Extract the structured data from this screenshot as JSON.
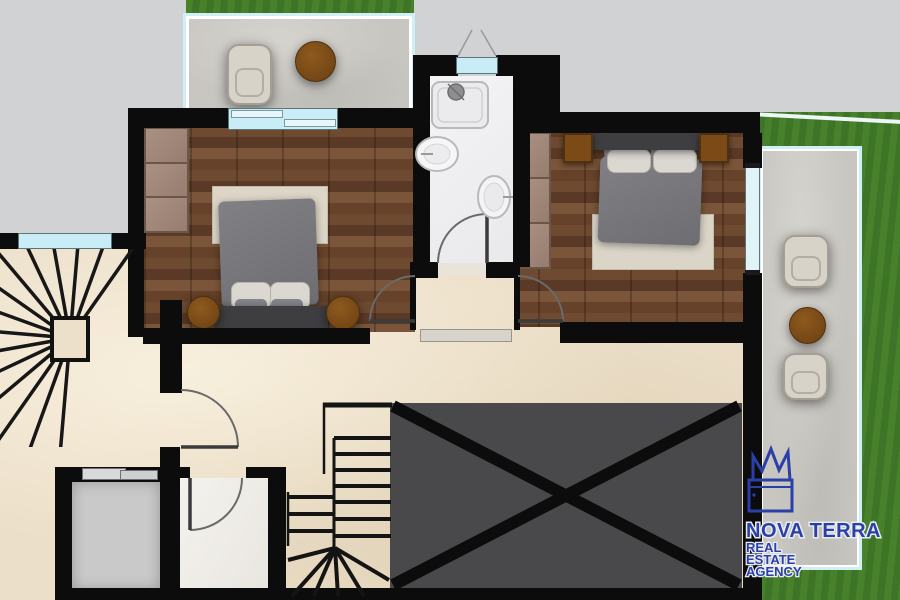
{
  "brand": {
    "name": "NOVA TERRA",
    "tagline_lines": [
      "REAL",
      "ESTATE",
      "AGENCY"
    ],
    "logo_color": "#2a3fa8",
    "logo_icon": "crown-castle-sketch"
  },
  "palette": {
    "outside": "#d1d2d3",
    "grass": "#447d2a",
    "wall": "#0c0c0d",
    "marble_floor": "#ecdfc9",
    "wood_floor": "#6e4a31",
    "stone_paving": "#c8c6c1",
    "glass": "#c8edf6",
    "void_fill": "#49494b",
    "wood_furniture": "#7c4a16",
    "bedding_gray": "#76767b",
    "wardrobe_panel": "#a18779"
  },
  "plan": {
    "type": "floor-plan-render",
    "rooms": [
      {
        "id": "bedroom-left",
        "floor": "wood",
        "furniture": [
          "double-bed",
          "wardrobe",
          "round-nightstand",
          "round-nightstand",
          "rug"
        ]
      },
      {
        "id": "bedroom-right",
        "floor": "wood",
        "furniture": [
          "double-bed",
          "wardrobe",
          "square-nightstand",
          "square-nightstand",
          "rug"
        ]
      },
      {
        "id": "bathroom",
        "floor": "tile",
        "furniture": [
          "shower",
          "washbasin",
          "toilet"
        ]
      },
      {
        "id": "hallway",
        "floor": "marble",
        "furniture": []
      },
      {
        "id": "stair-upper",
        "floor": "marble",
        "furniture": [
          "winder-staircase"
        ]
      },
      {
        "id": "stair-lower",
        "floor": "marble",
        "furniture": [
          "staircase-down"
        ]
      },
      {
        "id": "void",
        "floor": "none",
        "furniture": []
      },
      {
        "id": "utility-room",
        "floor": "concrete",
        "furniture": [
          "sliding-door"
        ]
      },
      {
        "id": "wc",
        "floor": "marble",
        "furniture": []
      },
      {
        "id": "balcony",
        "floor": "stone",
        "furniture": [
          "armchair",
          "round-table"
        ]
      },
      {
        "id": "terrace",
        "floor": "stone",
        "furniture": [
          "armchair",
          "round-table",
          "armchair"
        ]
      }
    ]
  }
}
